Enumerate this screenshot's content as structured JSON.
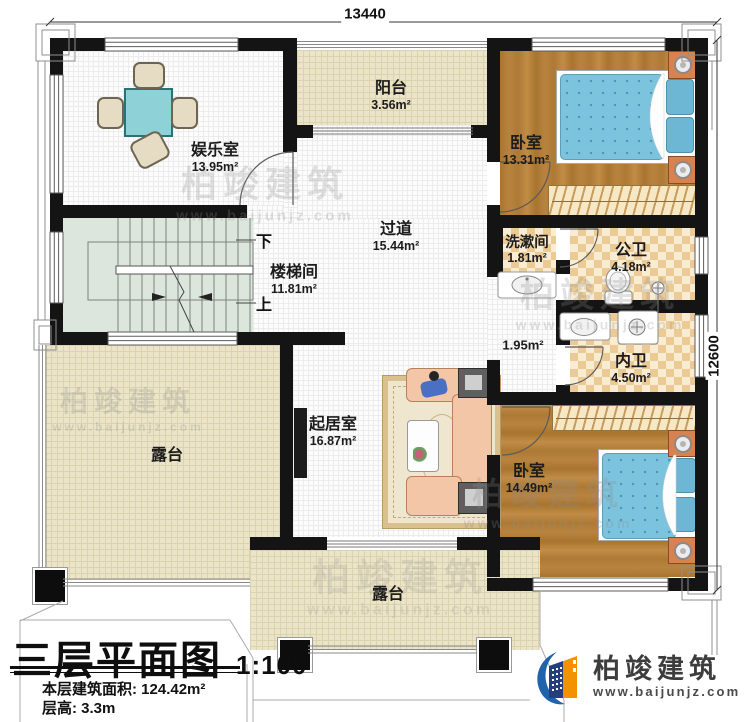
{
  "title": {
    "main": "三层平面图",
    "scale": "1:100",
    "area_line": "本层建筑面积: 124.42m²",
    "height_line": "层高: 3.3m"
  },
  "dimensions": {
    "width": "13440",
    "height": "12600"
  },
  "rooms": {
    "entertainment": {
      "name": "娱乐室",
      "area": "13.95m²"
    },
    "balcony": {
      "name": "阳台",
      "area": "3.56m²"
    },
    "bedroom1": {
      "name": "卧室",
      "area": "13.31m²"
    },
    "corridor": {
      "name": "过道",
      "area": "15.44m²"
    },
    "washroom": {
      "name": "洗漱间",
      "area": "1.81m²"
    },
    "public_bath": {
      "name": "公卫",
      "area": "4.18m²"
    },
    "stairwell": {
      "name": "楼梯间",
      "area": "11.81m²"
    },
    "lobby": {
      "area": "1.95m²"
    },
    "private_bath": {
      "name": "内卫",
      "area": "4.50m²"
    },
    "living": {
      "name": "起居室",
      "area": "16.87m²"
    },
    "bedroom2": {
      "name": "卧室",
      "area": "14.49m²"
    },
    "terrace_left": {
      "name": "露台"
    },
    "terrace_bottom": {
      "name": "露台"
    }
  },
  "stairs": {
    "down": "下",
    "up": "上"
  },
  "brand": {
    "name": "柏竣建筑",
    "url": "www.baijunjz.com"
  },
  "watermark": {
    "name": "柏竣建筑",
    "url": "www.baijunjz.com"
  },
  "colors": {
    "wall": "#141414",
    "wood": "#b5813f",
    "bed_blue": "#7cc4de",
    "checker_tan": "#ecca96",
    "brand_orange": "#f39200",
    "brand_blue": "#2063ad"
  }
}
